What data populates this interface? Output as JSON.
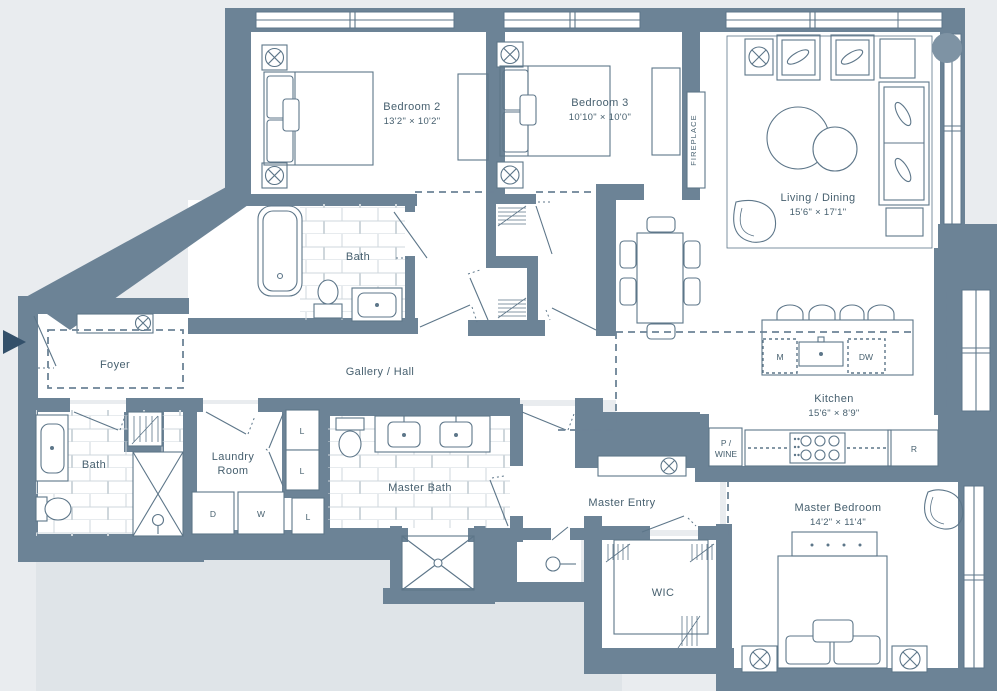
{
  "floorplan": {
    "rooms": {
      "bedroom2": {
        "name": "Bedroom 2",
        "dims": "13'2\" × 10'2\""
      },
      "bedroom3": {
        "name": "Bedroom 3",
        "dims": "10'10\" × 10'0\""
      },
      "living_dining": {
        "name": "Living / Dining",
        "dims": "15'6\" × 17'1\""
      },
      "kitchen": {
        "name": "Kitchen",
        "dims": "15'6\" × 8'9\""
      },
      "master_bedroom": {
        "name": "Master Bedroom",
        "dims": "14'2\" × 11'4\""
      },
      "bath_upper": {
        "name": "Bath"
      },
      "bath_lower": {
        "name": "Bath"
      },
      "master_bath": {
        "name": "Master Bath"
      },
      "foyer": {
        "name": "Foyer"
      },
      "gallery_hall": {
        "name": "Gallery / Hall"
      },
      "laundry_room": {
        "line1": "Laundry",
        "line2": "Room"
      },
      "master_entry": {
        "name": "Master Entry"
      },
      "wic": {
        "name": "WIC"
      },
      "fireplace_label": "FIREPLACE"
    },
    "appliances": {
      "microwave": "M",
      "dishwasher": "DW",
      "refrigerator": "R",
      "dryer": "D",
      "washer": "W",
      "linen": "L",
      "pantry_wine_line1": "P /",
      "pantry_wine_line2": "WINE"
    },
    "colors": {
      "wall": "#6c8396",
      "bg": "#e9ecef",
      "terrace": "#dfe4e8",
      "line": "#5d7689",
      "txt": "#47606f",
      "arrow": "#33506a",
      "column": "#7e93a4",
      "tile": "#cfd7dc"
    }
  }
}
